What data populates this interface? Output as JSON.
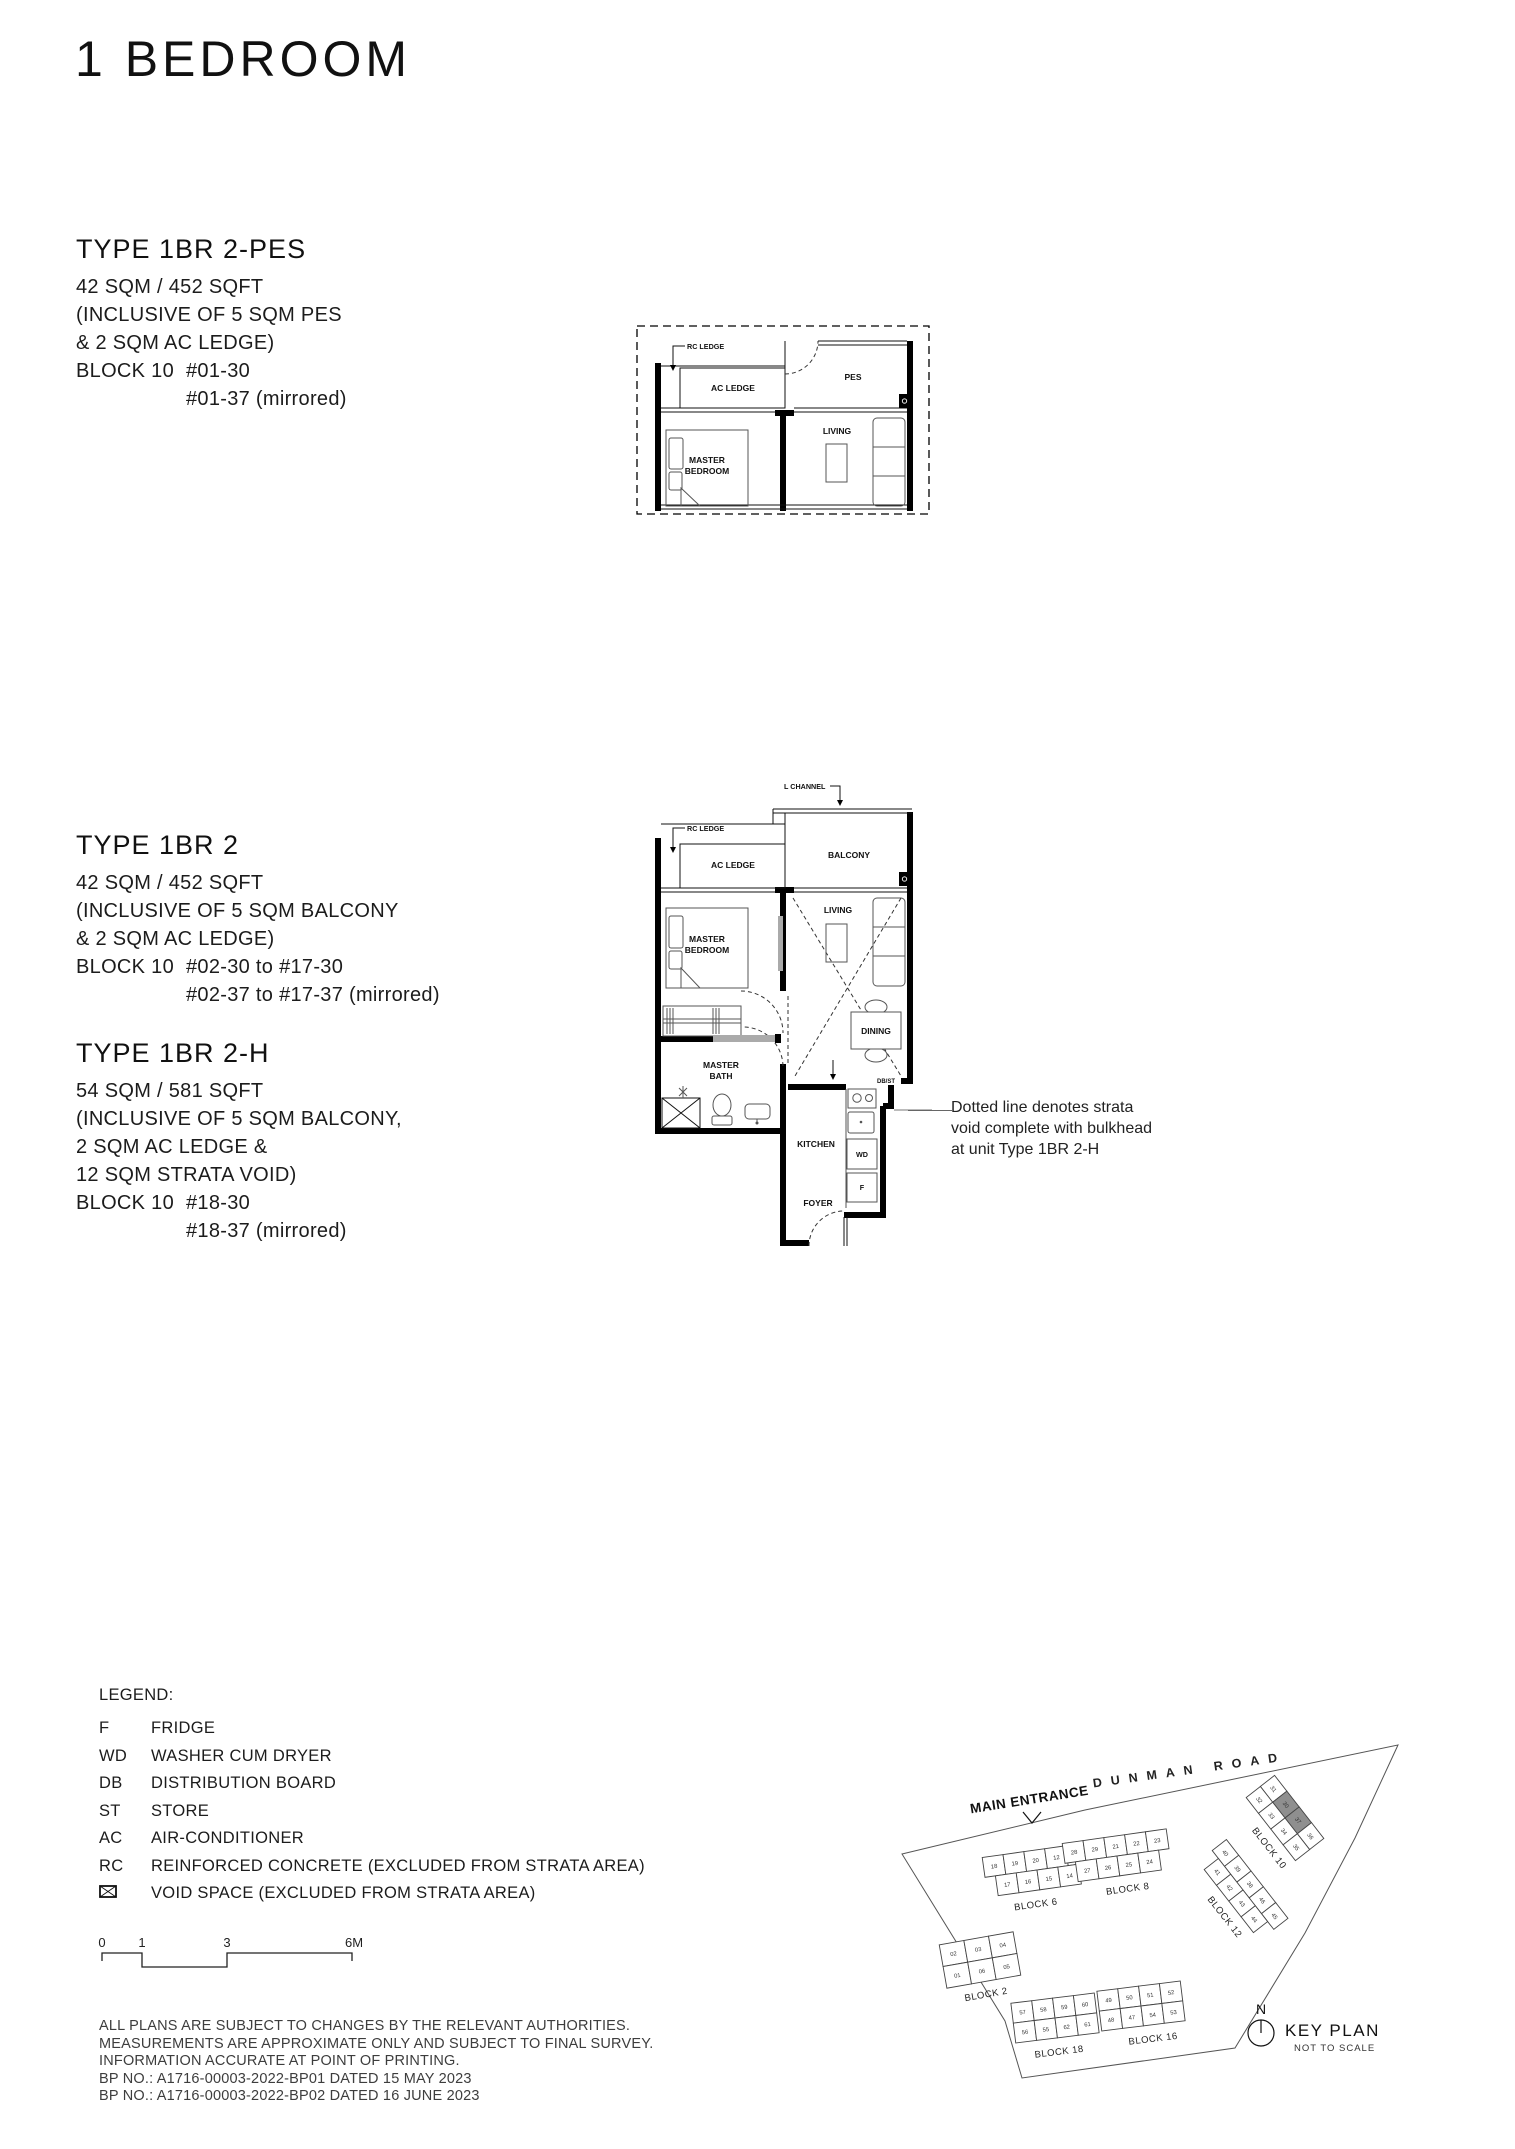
{
  "page": {
    "title": "1 BEDROOM"
  },
  "types": [
    {
      "name": "TYPE 1BR 2-PES",
      "area": "42 SQM / 452 SQFT",
      "details": [
        "(INCLUSIVE OF 5 SQM PES",
        "& 2 SQM AC LEDGE)"
      ],
      "block": "BLOCK 10",
      "units": [
        "#01-30",
        "#01-37 (mirrored)"
      ]
    },
    {
      "name": "TYPE 1BR 2",
      "area": "42 SQM / 452 SQFT",
      "details": [
        "(INCLUSIVE OF 5 SQM BALCONY",
        "& 2 SQM AC LEDGE)"
      ],
      "block": "BLOCK 10",
      "units": [
        "#02-30 to #17-30",
        "#02-37 to #17-37 (mirrored)"
      ]
    },
    {
      "name": "TYPE 1BR 2-H",
      "area": "54 SQM / 581 SQFT",
      "details": [
        "(INCLUSIVE OF 5 SQM BALCONY,",
        "2 SQM AC LEDGE &",
        "12 SQM STRATA VOID)"
      ],
      "block": "BLOCK 10",
      "units": [
        "#18-30",
        "#18-37 (mirrored)"
      ]
    }
  ],
  "plan_small": {
    "labels": {
      "rc_ledge": "RC LEDGE",
      "ac_ledge": "AC LEDGE",
      "pes": "PES",
      "living": "LIVING",
      "master_1": "MASTER",
      "master_2": "BEDROOM"
    }
  },
  "plan_large": {
    "labels": {
      "l_channel": "L CHANNEL",
      "rc_ledge": "RC LEDGE",
      "ac_ledge": "AC LEDGE",
      "balcony": "BALCONY",
      "living": "LIVING",
      "master_1": "MASTER",
      "master_2": "BEDROOM",
      "bath_1": "MASTER",
      "bath_2": "BATH",
      "dining": "DINING",
      "dbst": "DB/ST",
      "kitchen": "KITCHEN",
      "wd": "WD",
      "fridge": "F",
      "foyer": "FOYER"
    }
  },
  "annotation": {
    "lines": [
      "Dotted line denotes strata",
      "void complete with bulkhead",
      "at unit Type 1BR 2-H"
    ]
  },
  "legend": {
    "title": "LEGEND:",
    "items": [
      {
        "abbr": "F",
        "desc": "FRIDGE"
      },
      {
        "abbr": "WD",
        "desc": "WASHER CUM DRYER"
      },
      {
        "abbr": "DB",
        "desc": "DISTRIBUTION BOARD"
      },
      {
        "abbr": "ST",
        "desc": "STORE"
      },
      {
        "abbr": "AC",
        "desc": "AIR-CONDITIONER"
      },
      {
        "abbr": "RC",
        "desc": "REINFORCED CONCRETE (EXCLUDED FROM STRATA AREA)"
      },
      {
        "abbr": "",
        "desc": "VOID SPACE (EXCLUDED FROM STRATA AREA)",
        "icon": "void-space-icon"
      }
    ]
  },
  "scale_bar": {
    "ticks": [
      "0",
      "1",
      "3",
      "6M"
    ]
  },
  "disclaimer": [
    "ALL PLANS ARE SUBJECT TO CHANGES BY THE RELEVANT AUTHORITIES.",
    "MEASUREMENTS ARE APPROXIMATE ONLY AND SUBJECT TO FINAL SURVEY.",
    "INFORMATION ACCURATE AT POINT OF PRINTING.",
    "BP NO.: A1716-00003-2022-BP01 DATED 15 MAY 2023",
    "BP NO.: A1716-00003-2022-BP02 DATED 16 JUNE 2023"
  ],
  "keyplan": {
    "entrance": "MAIN ENTRANCE",
    "road": "DUNMAN ROAD",
    "north": "N",
    "title": "KEY PLAN",
    "subtitle": "NOT TO SCALE",
    "highlighted": [
      "30",
      "37"
    ],
    "blocks": [
      {
        "label": "BLOCK 2",
        "rows": [
          [
            "02",
            "03",
            "04"
          ],
          [
            "01",
            "06",
            "05"
          ]
        ]
      },
      {
        "label": "BLOCK 6",
        "rows": [
          [
            "18",
            "19",
            "20",
            "12",
            "13"
          ],
          [
            "17",
            "16",
            "15",
            "14"
          ]
        ]
      },
      {
        "label": "BLOCK 8",
        "rows": [
          [
            "28",
            "29",
            "21",
            "22",
            "23"
          ],
          [
            "27",
            "26",
            "25",
            "24"
          ]
        ]
      },
      {
        "label": "BLOCK 10",
        "rows": [
          [
            "31",
            "30",
            "37",
            "36"
          ],
          [
            "32",
            "33",
            "34",
            "35"
          ]
        ]
      },
      {
        "label": "BLOCK 12",
        "rows": [
          [
            "40",
            "39",
            "38",
            "46",
            "45"
          ],
          [
            "41",
            "42",
            "43",
            "44"
          ]
        ]
      },
      {
        "label": "BLOCK 16",
        "rows": [
          [
            "49",
            "50",
            "51",
            "52"
          ],
          [
            "48",
            "47",
            "54",
            "53"
          ]
        ]
      },
      {
        "label": "BLOCK 18",
        "rows": [
          [
            "57",
            "58",
            "59",
            "60"
          ],
          [
            "56",
            "55",
            "62",
            "61"
          ]
        ]
      }
    ]
  }
}
